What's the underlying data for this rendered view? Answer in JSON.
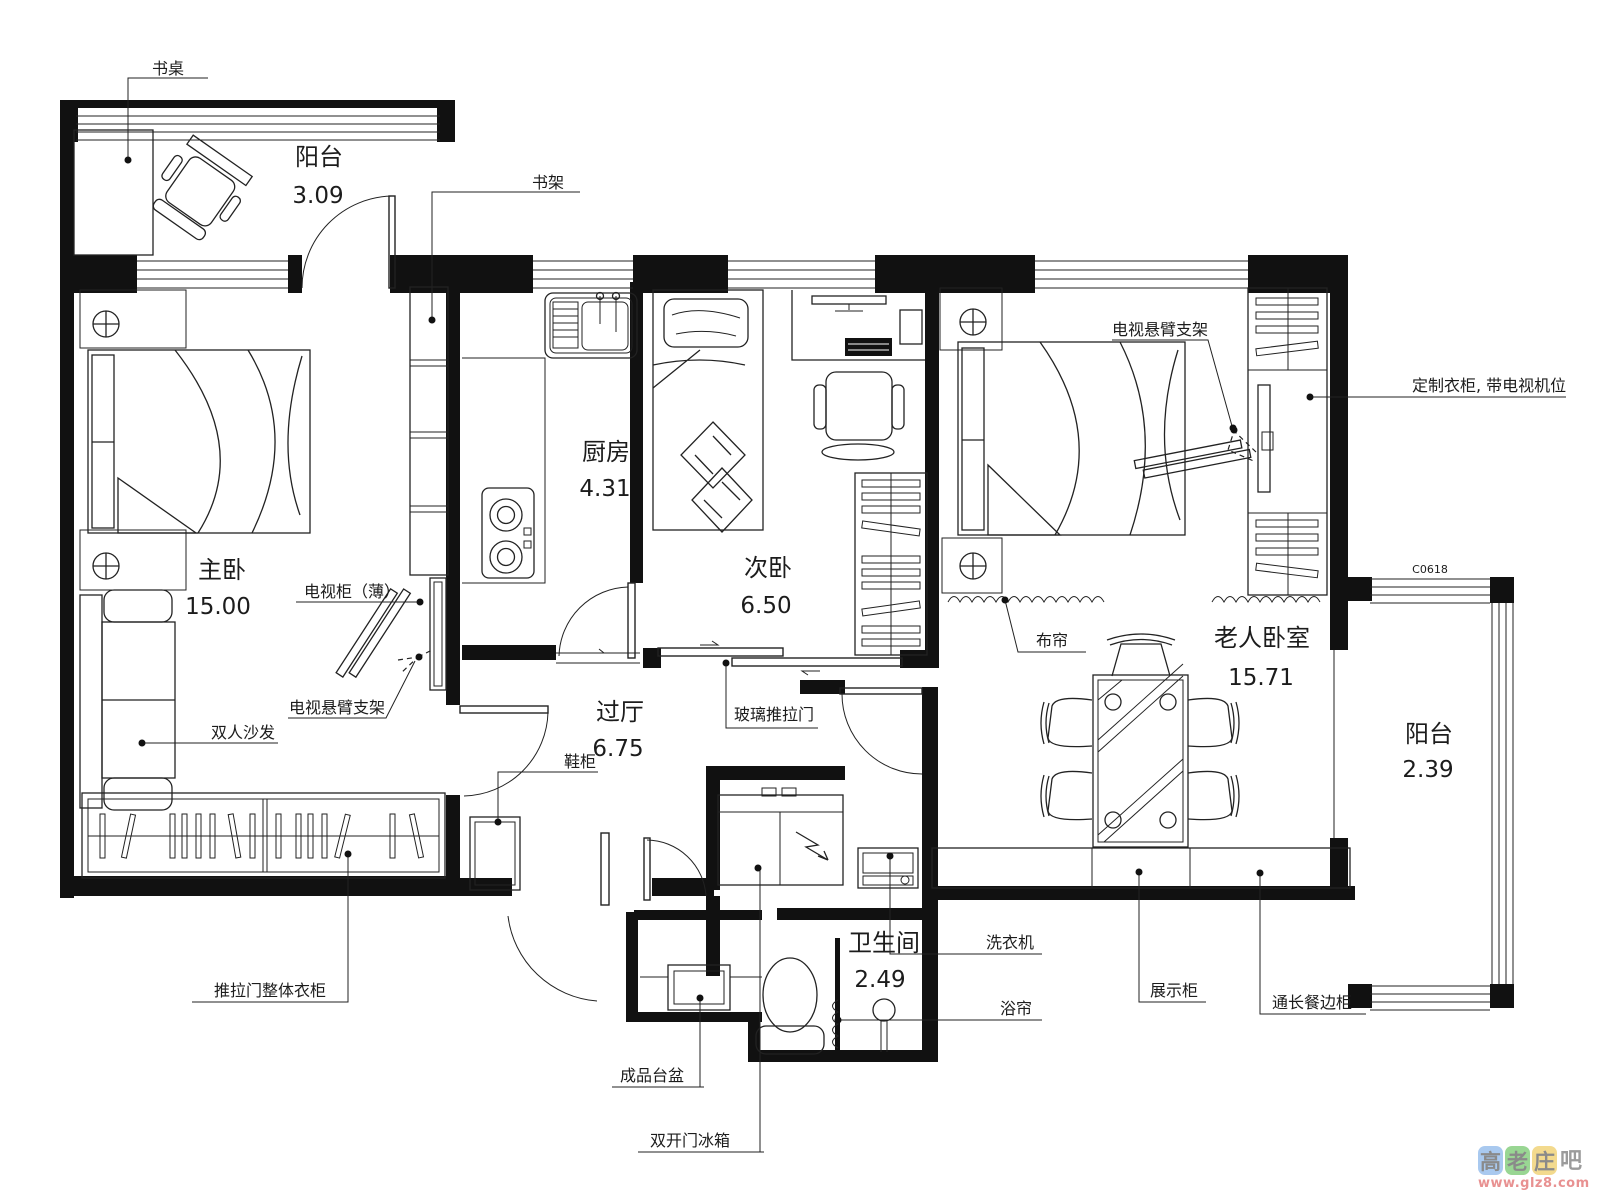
{
  "drawing": {
    "type": "apartment-floor-plan"
  },
  "rooms": [
    {
      "id": "balcony-top",
      "name": "阳台",
      "area": "3.09"
    },
    {
      "id": "master-bedroom",
      "name": "主卧",
      "area": "15.00"
    },
    {
      "id": "kitchen",
      "name": "厨房",
      "area": "4.31"
    },
    {
      "id": "second-bedroom",
      "name": "次卧",
      "area": "6.50"
    },
    {
      "id": "hallway",
      "name": "过厅",
      "area": "6.75"
    },
    {
      "id": "elder-bedroom",
      "name": "老人卧室",
      "area": "15.71"
    },
    {
      "id": "balcony-right",
      "name": "阳台",
      "area": "2.39"
    },
    {
      "id": "bathroom",
      "name": "卫生间",
      "area": "2.49"
    }
  ],
  "labels": {
    "desk": "书桌",
    "bookshelf": "书架",
    "tv_cabinet_thin": "电视柜（薄）",
    "tv_arm_left": "电视悬臂支架",
    "double_sofa": "双人沙发",
    "shoe_cabinet": "鞋柜",
    "glass_sliding_door": "玻璃推拉门",
    "tv_arm_right": "电视悬臂支架",
    "custom_wardrobe": "定制衣柜, 带电视机位",
    "cloth_curtain": "布帘",
    "window_code": "C0618",
    "sliding_door_wardrobe": "推拉门整体衣柜",
    "finished_basin": "成品台盆",
    "double_door_fridge": "双开门冰箱",
    "washing_machine": "洗衣机",
    "shower_curtain": "浴帘",
    "display_cabinet": "展示柜",
    "long_sideboard": "通长餐边柜"
  },
  "watermark": {
    "site_chars": [
      "高",
      "老",
      "庄"
    ],
    "suffix_char": "吧",
    "url": "www.glz8.com",
    "tile_colors": [
      "#a9c9ef",
      "#99d693",
      "#f3da8e"
    ],
    "url_color": "#e89191",
    "char_color": "#8a8a8a"
  }
}
